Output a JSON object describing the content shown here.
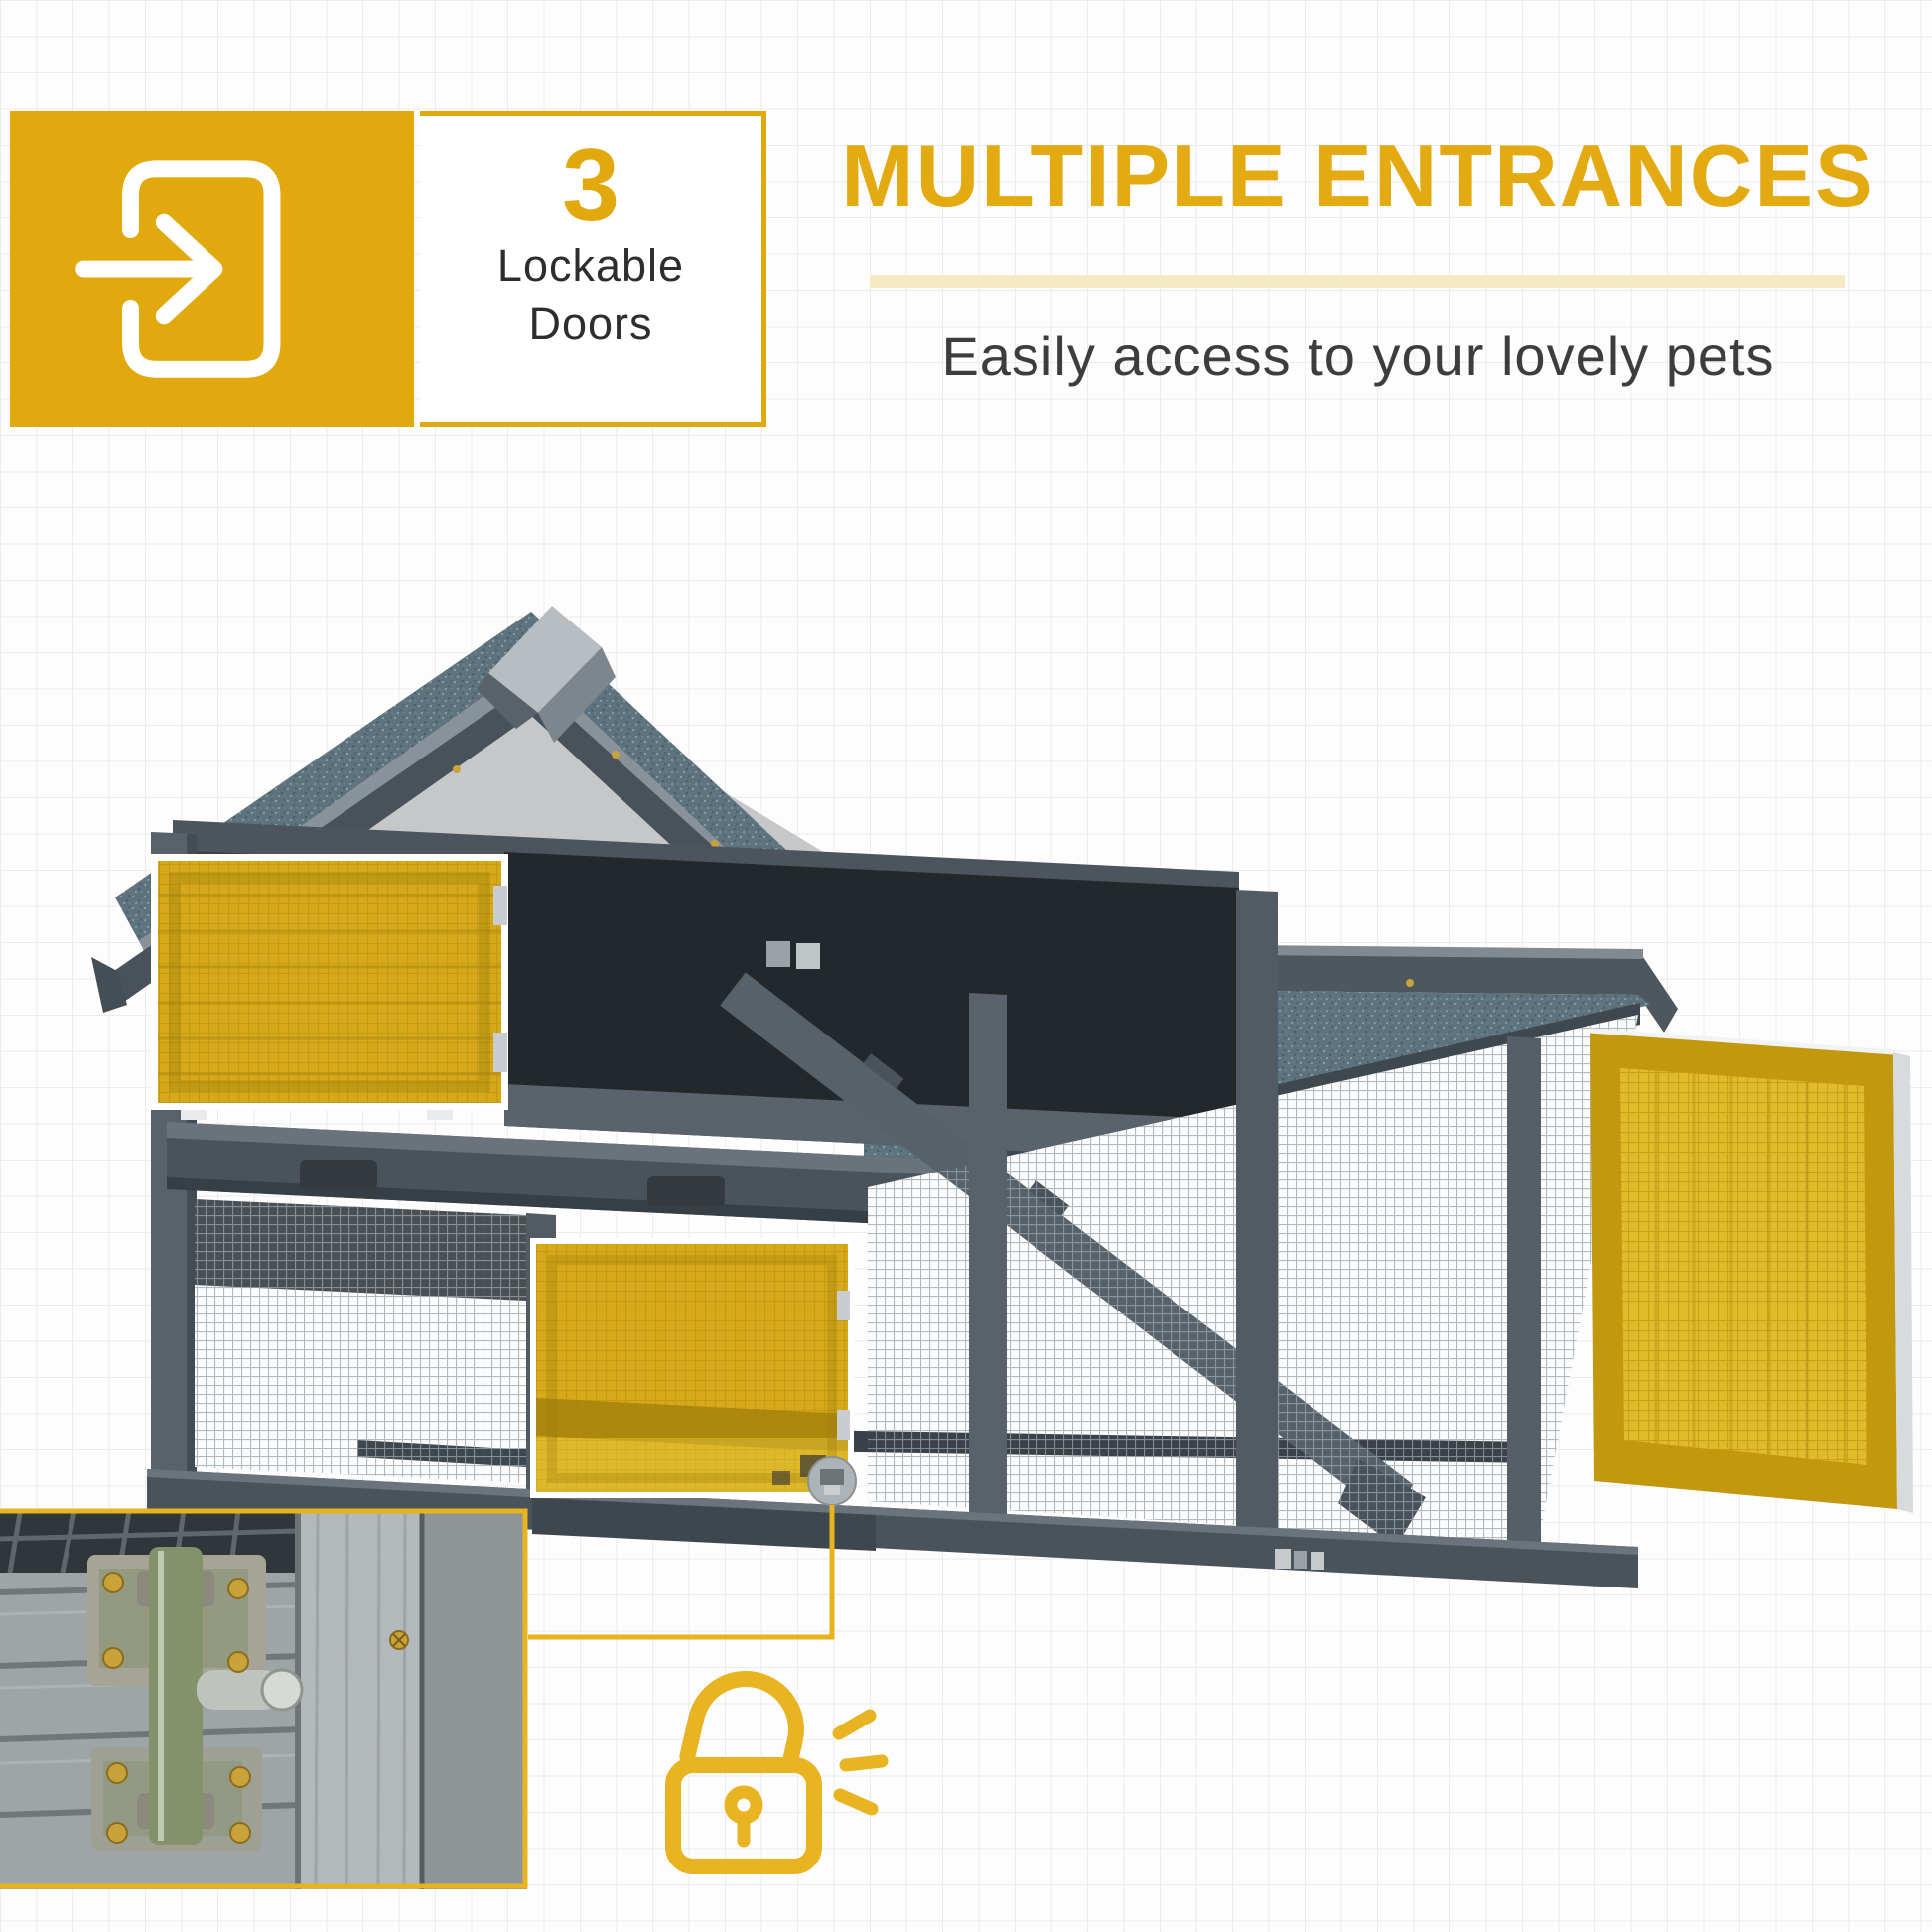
{
  "colors": {
    "accent_yellow": "#E2A90F",
    "heading_yellow": "#E3AA12",
    "pale_underline": "#F6E9C3",
    "door_highlight_yellow": "#D7A91A",
    "connector_yellow": "#E7B41F",
    "text_dark": "#2e2e2e",
    "hutch_wood_gray": "#59626B",
    "roof_asphalt": "#5d737e",
    "background": "#fdfdfd",
    "grid_line": "#ececec"
  },
  "feature_badge": {
    "icon": "door-enter-icon",
    "count": "3",
    "label_lines": [
      "Lockable",
      "Doors"
    ]
  },
  "header": {
    "title": "MULTIPLE ENTRANCES",
    "subtitle": "Easily access to your lovely pets"
  },
  "photo": {
    "subject": "gray wooden pet hutch with asphalt roof and wire mesh run",
    "highlighted_doors": [
      "upper-left-hutch-door",
      "lower-middle-run-door",
      "right-run-door"
    ],
    "detail_marker_icon": "zoom-detail-marker",
    "detail_inset": "door-latch-closeup-photo",
    "lock_icon": "unlocked-padlock-icon"
  }
}
